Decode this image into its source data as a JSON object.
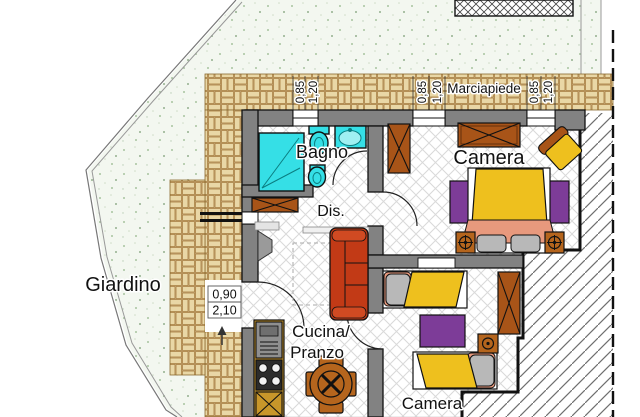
{
  "plan_title": "Apartment floor plan",
  "labels": {
    "garden": "Giardino",
    "sidewalk": "Marciapiede",
    "bathroom": "Bagno",
    "hallway": "Dis.",
    "bedroom1": "Camera",
    "kitchen_line1": "Cucina/",
    "kitchen_line2": "Pranzo",
    "bedroom2": "Camera"
  },
  "dimensions": {
    "window_width": "0,85",
    "window_height": "1,20",
    "door_width": "0,90",
    "door_height": "2,10"
  },
  "colors": {
    "wall": "#828282",
    "brick": "#e9d7a6",
    "brick_bg": "#f9f2e2",
    "garden": "#f3f7f0",
    "floor_line": "#d9d9d9",
    "hatch": "#6e6e6e",
    "fixture": "#35dfe6",
    "bed": "#eec01e",
    "rug": "#7d3c98",
    "wood": "#a85418",
    "wood2": "#b5651d",
    "sofa": "#c23a16",
    "blanket": "#e8997d",
    "pillow": "#b8b8b8"
  }
}
